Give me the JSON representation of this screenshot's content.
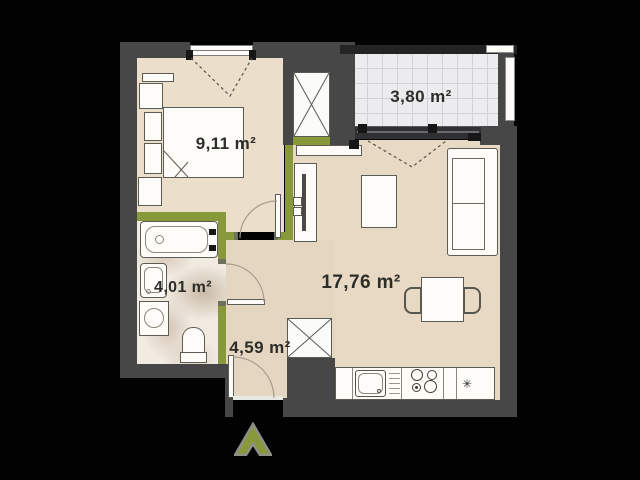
{
  "rooms": {
    "bedroom": {
      "name": "bedroom",
      "label": "9,11 m²"
    },
    "balcony": {
      "name": "balcony",
      "label": "3,80 m²"
    },
    "living": {
      "name": "living-room-with-kitchenette",
      "label": "17,76 m²"
    },
    "bathroom": {
      "name": "bathroom",
      "label": "4,01 m²"
    },
    "hall": {
      "name": "hall",
      "label": "4,59 m²"
    }
  },
  "icons": {
    "freezer": "✳",
    "entrance_marker": "arrow-up"
  },
  "colors": {
    "background": "#020202",
    "wall": "#474747",
    "accent_wall": "#87993a",
    "floor": "#e8d9c4",
    "bathroom_floor": "#f1ebe2",
    "balcony_floor": "#ececee",
    "label_text": "#2d2d28"
  }
}
